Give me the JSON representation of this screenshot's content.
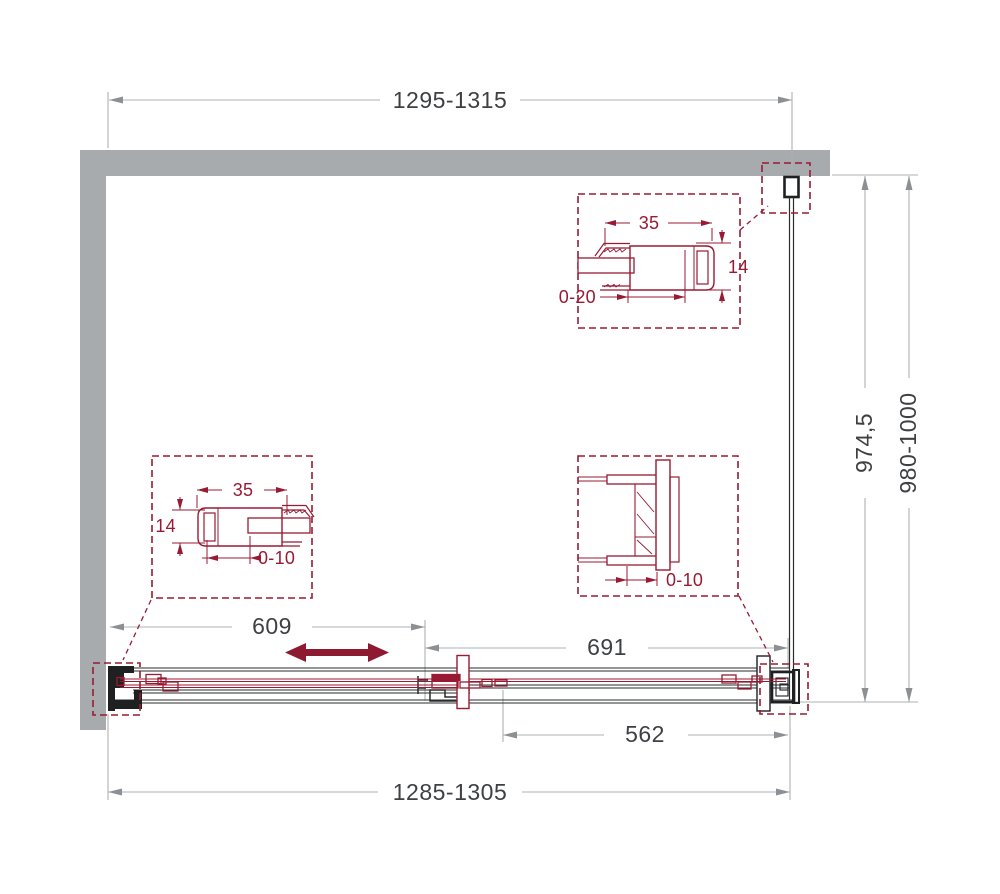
{
  "drawing": {
    "type": "shower-enclosure-technical-plan",
    "colors": {
      "wall": "#A8ABAD",
      "maroon": "#981B33",
      "slide_arrow": "#8E1A31",
      "dim_line": "#AEB1B3",
      "dim_arrow": "#8D9092",
      "dim_text": "#3E4043",
      "line_black": "#2A2C2E"
    },
    "dimensions": {
      "top_width": "1295-1315",
      "bottom_width": "1285-1305",
      "height_inner": "974,5",
      "height_outer": "980-1000",
      "door_section_left": "609",
      "door_section_right": "691",
      "opening_width": "562"
    },
    "detail_top_profile": {
      "width": "35",
      "depth": "14",
      "adjust": "0-20"
    },
    "detail_bottom_profile": {
      "width": "35",
      "depth": "14",
      "adjust": "0-10"
    },
    "detail_bracket": {
      "adjust": "0-10"
    }
  }
}
